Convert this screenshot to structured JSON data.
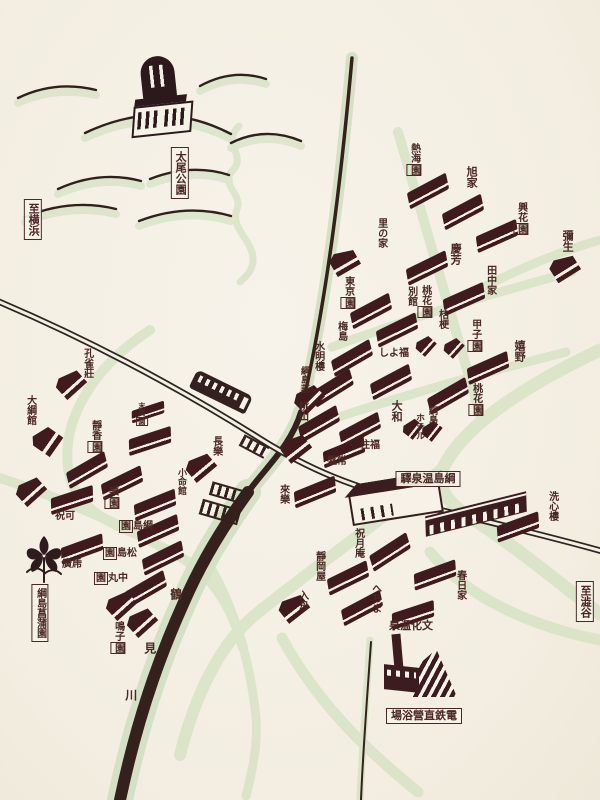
{
  "map": {
    "title": "綱島温泉案内図",
    "colors": {
      "paper": "#f4efe4",
      "building": "#3f1b1e",
      "ink": "#33201c",
      "label": "#4a2823",
      "road_green": "#d9e4c7",
      "river": "#35211b"
    },
    "labels": [
      {
        "id": "sign-to-yokohama",
        "text": "至横浜",
        "x": 33,
        "y": 199,
        "dir": "v",
        "boxed": "all",
        "size": 11
      },
      {
        "id": "sign-taio-park",
        "text": "太尾公園",
        "x": 180,
        "y": 147,
        "dir": "v",
        "boxed": "all",
        "size": 11
      },
      {
        "id": "sign-tsunashima-onsen-station",
        "text": "驛泉温島綱",
        "x": 428,
        "y": 471,
        "dir": "h",
        "boxed": "all",
        "size": 11
      },
      {
        "id": "sign-tsunashima-iris-garden",
        "text": "綱島菖蒲園",
        "x": 40,
        "y": 584,
        "dir": "v",
        "boxed": "all",
        "size": 10
      },
      {
        "id": "sign-dentetsu-bathhouse",
        "text": "場浴營直鉄電",
        "x": 424,
        "y": 708,
        "dir": "h",
        "boxed": "all",
        "size": 11
      },
      {
        "id": "sign-to-shibuya",
        "text": "至澁谷",
        "x": 585,
        "y": 581,
        "dir": "v",
        "boxed": "all",
        "size": 11
      },
      {
        "id": "atamien",
        "text": "熱海園",
        "x": 414,
        "y": 143,
        "dir": "v",
        "boxed": "last",
        "size": 10
      },
      {
        "id": "asahiya",
        "text": "旭家",
        "x": 471,
        "y": 166,
        "dir": "v",
        "boxed": "none",
        "size": 11
      },
      {
        "id": "kokaen",
        "text": "興花園",
        "x": 521,
        "y": 202,
        "dir": "v",
        "boxed": "last",
        "size": 10
      },
      {
        "id": "yayoi",
        "text": "彌生",
        "x": 567,
        "y": 230,
        "dir": "v",
        "boxed": "none",
        "size": 11
      },
      {
        "id": "sato-no-ie",
        "text": "里の家",
        "x": 381,
        "y": 218,
        "dir": "v",
        "boxed": "none",
        "size": 10
      },
      {
        "id": "keiho",
        "text": "慶芳",
        "x": 455,
        "y": 243,
        "dir": "v",
        "boxed": "none",
        "size": 11
      },
      {
        "id": "tanakaya",
        "text": "田中家",
        "x": 490,
        "y": 265,
        "dir": "v",
        "boxed": "none",
        "size": 10
      },
      {
        "id": "tokyoen",
        "text": "東京園",
        "x": 348,
        "y": 276,
        "dir": "v",
        "boxed": "last",
        "size": 10
      },
      {
        "id": "tokaen-bekkan-main",
        "text": "桃花園",
        "x": 425,
        "y": 285,
        "dir": "v",
        "boxed": "last",
        "size": 10
      },
      {
        "id": "tokaen-bekkan-annex",
        "text": "別館",
        "x": 411,
        "y": 286,
        "dir": "v",
        "boxed": "none",
        "size": 10
      },
      {
        "id": "kikyo",
        "text": "桔梗",
        "x": 442,
        "y": 309,
        "dir": "v",
        "boxed": "none",
        "size": 10
      },
      {
        "id": "koshien",
        "text": "甲子園",
        "x": 475,
        "y": 319,
        "dir": "v",
        "boxed": "last",
        "size": 10
      },
      {
        "id": "ureshino",
        "text": "嬉野",
        "x": 519,
        "y": 340,
        "dir": "v",
        "boxed": "none",
        "size": 11
      },
      {
        "id": "umejima",
        "text": "梅島",
        "x": 341,
        "y": 321,
        "dir": "v",
        "boxed": "none",
        "size": 10
      },
      {
        "id": "suimeiro",
        "text": "水明樓",
        "x": 318,
        "y": 341,
        "dir": "v",
        "boxed": "none",
        "size": 10
      },
      {
        "id": "tsunashimaso",
        "text": "綱島莊",
        "x": 304,
        "y": 366,
        "dir": "v",
        "boxed": "none",
        "size": 9
      },
      {
        "id": "momoyama",
        "text": "桃山",
        "x": 302,
        "y": 401,
        "dir": "v",
        "boxed": "none",
        "size": 10
      },
      {
        "id": "shoyofuku",
        "text": "しよ福",
        "x": 394,
        "y": 348,
        "dir": "h",
        "boxed": "none",
        "size": 10
      },
      {
        "id": "yamato",
        "text": "大和",
        "x": 396,
        "y": 400,
        "dir": "v",
        "boxed": "none",
        "size": 11
      },
      {
        "id": "tsunashima-hotel-1",
        "text": "綱島",
        "x": 432,
        "y": 406,
        "dir": "v",
        "boxed": "none",
        "size": 9
      },
      {
        "id": "tsunashima-hotel-2",
        "text": "ホテル",
        "x": 419,
        "y": 413,
        "dir": "v",
        "boxed": "none",
        "size": 9
      },
      {
        "id": "tokaen-east",
        "text": "桃花園",
        "x": 476,
        "y": 383,
        "dir": "v",
        "boxed": "last",
        "size": 10
      },
      {
        "id": "sumifuku",
        "text": "住福",
        "x": 370,
        "y": 440,
        "dir": "h",
        "boxed": "none",
        "size": 10
      },
      {
        "id": "banjo",
        "text": "盤常",
        "x": 337,
        "y": 456,
        "dir": "h",
        "boxed": "none",
        "size": 10
      },
      {
        "id": "rairaku",
        "text": "來樂",
        "x": 283,
        "y": 484,
        "dir": "v",
        "boxed": "none",
        "size": 10
      },
      {
        "id": "choraku",
        "text": "長樂",
        "x": 216,
        "y": 436,
        "dir": "v",
        "boxed": "none",
        "size": 10
      },
      {
        "id": "shomeikan",
        "text": "小命館",
        "x": 181,
        "y": 468,
        "dir": "v",
        "boxed": "none",
        "size": 9
      },
      {
        "id": "kujakuso",
        "text": "孔雀莊",
        "x": 87,
        "y": 348,
        "dir": "v",
        "boxed": "none",
        "size": 10
      },
      {
        "id": "taikokan",
        "text": "大綱館",
        "x": 30,
        "y": 395,
        "dir": "v",
        "boxed": "none",
        "size": 10
      },
      {
        "id": "seikoen",
        "text": "靜香園",
        "x": 95,
        "y": 420,
        "dir": "v",
        "boxed": "last",
        "size": 10
      },
      {
        "id": "small-inn",
        "text": "末廣園",
        "x": 141,
        "y": 402,
        "dir": "v",
        "boxed": "last",
        "size": 7
      },
      {
        "id": "rakuen",
        "text": "樂園",
        "x": 112,
        "y": 486,
        "dir": "v",
        "boxed": "last",
        "size": 10
      },
      {
        "id": "shukuka",
        "text": "祝可",
        "x": 65,
        "y": 511,
        "dir": "h",
        "boxed": "none",
        "size": 10
      },
      {
        "id": "tsunashimaen",
        "text": "園島綱",
        "x": 136,
        "y": 521,
        "dir": "h",
        "boxed": "first",
        "size": 10
      },
      {
        "id": "matsushimaen",
        "text": "園島松",
        "x": 120,
        "y": 548,
        "dir": "h",
        "boxed": "first",
        "size": 10
      },
      {
        "id": "nakamaruen",
        "text": "園丸中",
        "x": 111,
        "y": 573,
        "dir": "h",
        "boxed": "first",
        "size": 10
      },
      {
        "id": "hirotora",
        "text": "廣乕",
        "x": 72,
        "y": 559,
        "dir": "h",
        "boxed": "none",
        "size": 10
      },
      {
        "id": "narukoen",
        "text": "鳴子園",
        "x": 118,
        "y": 621,
        "dir": "v",
        "boxed": "last",
        "size": 10
      },
      {
        "id": "senshinro",
        "text": "洗心樓",
        "x": 552,
        "y": 491,
        "dir": "v",
        "boxed": "none",
        "size": 10
      },
      {
        "id": "kasugaya",
        "text": "春日家",
        "x": 460,
        "y": 570,
        "dir": "v",
        "boxed": "none",
        "size": 10
      },
      {
        "id": "shukugetsuan",
        "text": "祝月庵",
        "x": 358,
        "y": 528,
        "dir": "v",
        "boxed": "none",
        "size": 10
      },
      {
        "id": "shizuokaya",
        "text": "靜岡屋",
        "x": 319,
        "y": 551,
        "dir": "v",
        "boxed": "none",
        "size": 10
      },
      {
        "id": "irifune",
        "text": "入舟",
        "x": 302,
        "y": 590,
        "dir": "v",
        "boxed": "none",
        "size": 10
      },
      {
        "id": "hechima",
        "text": "へちま",
        "x": 375,
        "y": 583,
        "dir": "v",
        "boxed": "none",
        "size": 10
      },
      {
        "id": "bunka-onsen",
        "text": "泉温化文",
        "x": 411,
        "y": 620,
        "dir": "h",
        "boxed": "none",
        "size": 11
      },
      {
        "id": "river-char-tsuru",
        "text": "鶴",
        "x": 175,
        "y": 588,
        "dir": "v",
        "boxed": "none",
        "size": 12
      },
      {
        "id": "river-char-mi",
        "text": "見",
        "x": 149,
        "y": 642,
        "dir": "v",
        "boxed": "none",
        "size": 12
      },
      {
        "id": "river-char-kawa",
        "text": "川",
        "x": 130,
        "y": 689,
        "dir": "v",
        "boxed": "none",
        "size": 12
      }
    ],
    "buildings": [
      {
        "x": 428,
        "y": 191,
        "r": -28,
        "t": "r"
      },
      {
        "x": 463,
        "y": 212,
        "r": -28,
        "t": "r"
      },
      {
        "x": 497,
        "y": 236,
        "r": -24,
        "t": "r"
      },
      {
        "x": 564,
        "y": 267,
        "r": -32,
        "t": "g"
      },
      {
        "x": 344,
        "y": 261,
        "r": -30,
        "t": "g"
      },
      {
        "x": 427,
        "y": 268,
        "r": -26,
        "t": "r"
      },
      {
        "x": 464,
        "y": 299,
        "r": -24,
        "t": "r"
      },
      {
        "x": 371,
        "y": 311,
        "r": -28,
        "t": "r"
      },
      {
        "x": 397,
        "y": 330,
        "r": -26,
        "t": "r"
      },
      {
        "x": 425,
        "y": 345,
        "r": -48,
        "t": "g",
        "w": 18,
        "h": 16
      },
      {
        "x": 453,
        "y": 347,
        "r": -48,
        "t": "g",
        "w": 18,
        "h": 16
      },
      {
        "x": 488,
        "y": 368,
        "r": -24,
        "t": "r"
      },
      {
        "x": 448,
        "y": 396,
        "r": -30,
        "t": "r"
      },
      {
        "x": 352,
        "y": 358,
        "r": -30,
        "t": "r"
      },
      {
        "x": 333,
        "y": 388,
        "r": -32,
        "t": "r"
      },
      {
        "x": 308,
        "y": 398,
        "r": -45,
        "t": "g"
      },
      {
        "x": 319,
        "y": 424,
        "r": -30,
        "t": "r"
      },
      {
        "x": 391,
        "y": 382,
        "r": -28,
        "t": "r"
      },
      {
        "x": 412,
        "y": 428,
        "r": -52,
        "t": "g",
        "w": 18,
        "h": 16
      },
      {
        "x": 431,
        "y": 430,
        "r": -52,
        "t": "g",
        "w": 18,
        "h": 16
      },
      {
        "x": 360,
        "y": 430,
        "r": -28,
        "t": "r"
      },
      {
        "x": 344,
        "y": 452,
        "r": -22,
        "t": "r"
      },
      {
        "x": 295,
        "y": 447,
        "r": -38,
        "t": "g"
      },
      {
        "x": 315,
        "y": 492,
        "r": -22,
        "t": "r"
      },
      {
        "x": 70,
        "y": 383,
        "r": -42,
        "t": "g"
      },
      {
        "x": 46,
        "y": 440,
        "r": -55,
        "t": "g",
        "w": 24,
        "h": 26
      },
      {
        "x": 150,
        "y": 441,
        "r": -18,
        "t": "r"
      },
      {
        "x": 148,
        "y": 412,
        "r": -18,
        "t": "r",
        "w": 34,
        "h": 12
      },
      {
        "x": 87,
        "y": 470,
        "r": -30,
        "t": "r"
      },
      {
        "x": 30,
        "y": 490,
        "r": -42,
        "t": "g"
      },
      {
        "x": 122,
        "y": 483,
        "r": -26,
        "t": "r"
      },
      {
        "x": 72,
        "y": 500,
        "r": -18,
        "t": "r"
      },
      {
        "x": 200,
        "y": 466,
        "r": -40,
        "t": "g"
      },
      {
        "x": 155,
        "y": 505,
        "r": -22,
        "t": "r"
      },
      {
        "x": 158,
        "y": 531,
        "r": -24,
        "t": "r"
      },
      {
        "x": 163,
        "y": 558,
        "r": -26,
        "t": "r"
      },
      {
        "x": 146,
        "y": 589,
        "r": -30,
        "t": "r"
      },
      {
        "x": 82,
        "y": 549,
        "r": -20,
        "t": "r"
      },
      {
        "x": 120,
        "y": 604,
        "r": -42,
        "t": "g"
      },
      {
        "x": 141,
        "y": 621,
        "r": -42,
        "t": "g"
      },
      {
        "x": 518,
        "y": 527,
        "r": -20,
        "t": "r"
      },
      {
        "x": 390,
        "y": 552,
        "r": -33,
        "t": "r"
      },
      {
        "x": 348,
        "y": 578,
        "r": -26,
        "t": "r"
      },
      {
        "x": 362,
        "y": 608,
        "r": -28,
        "t": "r"
      },
      {
        "x": 435,
        "y": 575,
        "r": -20,
        "t": "r"
      },
      {
        "x": 413,
        "y": 615,
        "r": -18,
        "t": "r"
      },
      {
        "x": 293,
        "y": 607,
        "r": -38,
        "t": "g"
      }
    ]
  }
}
